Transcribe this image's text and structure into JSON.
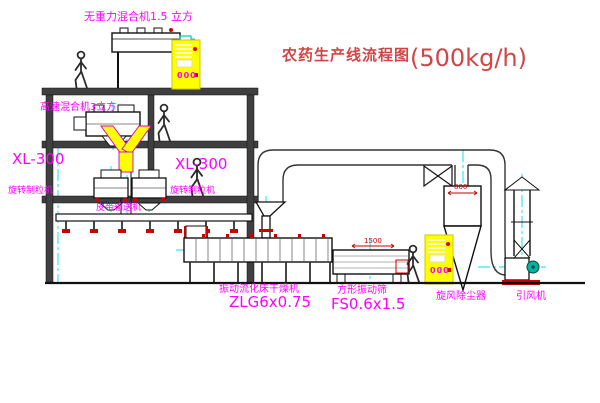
{
  "title": {
    "name": "农药生产线流程图",
    "capacity": "(500kg/h)"
  },
  "labels": {
    "top_mixer": "无重力混合机1.5 立方",
    "high_speed_mixer": "高速混合机3立方",
    "granulator_model_left": "XL-300",
    "granulator_left": "旋转制粒机",
    "granulator_model_mid": "XL-300",
    "granulator_mid": "旋转制粒机",
    "belt_conveyor": "皮带输送机",
    "dryer_name": "振动流化床干燥机",
    "dryer_model": "ZLG6x0.75",
    "sieve_name": "方形振动筛",
    "sieve_model": "FS0.6x1.5",
    "cyclone": "旋风除尘器",
    "fan": "引风机"
  },
  "dimensions": {
    "cyclone_width": "800",
    "sieve_length": "1500"
  },
  "cabinets": {
    "display": "000"
  },
  "colors": {
    "label": "#ff00ff",
    "title": "#d04545",
    "dimension": "#cc0000",
    "centerline": "#00e0e0",
    "cabinet": "#ffff00",
    "line": "#1a1a1a",
    "fan_motor": "#00b3a0"
  }
}
